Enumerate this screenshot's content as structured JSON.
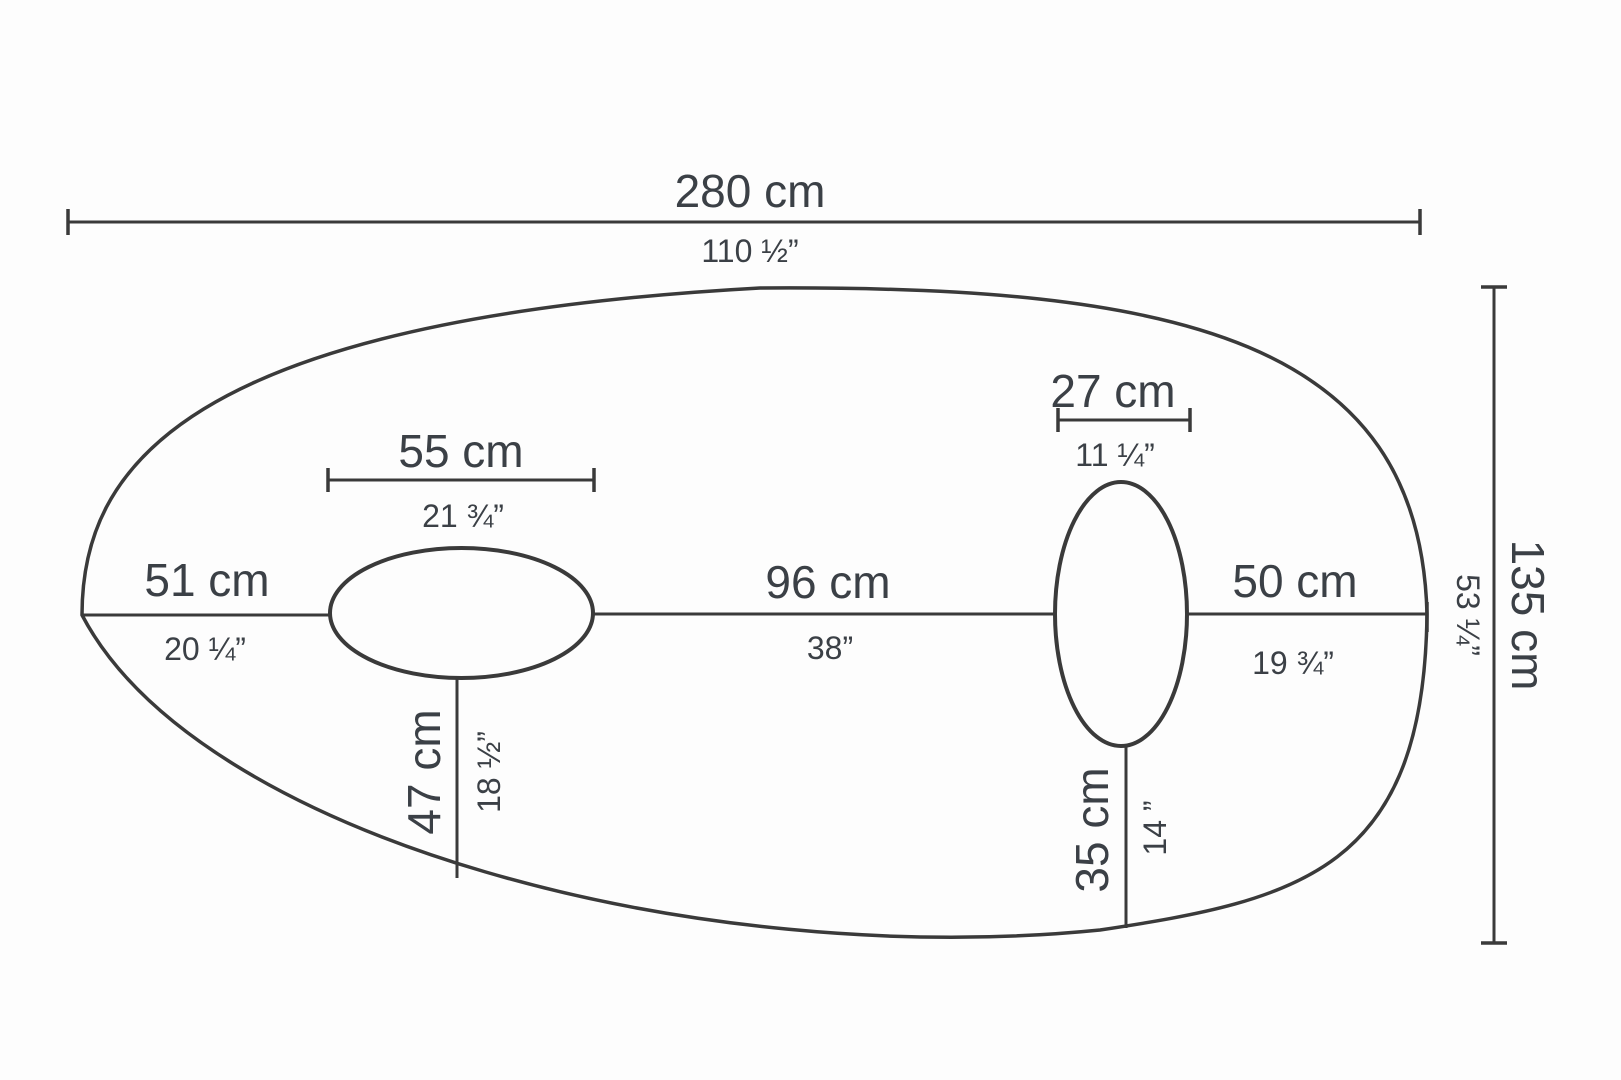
{
  "measurements": {
    "overall_width": {
      "metric": "280 cm",
      "imperial": "110 ½”"
    },
    "overall_height": {
      "metric": "135 cm",
      "imperial": "53 ¼”"
    },
    "left_edge_to_hole1": {
      "metric": "51 cm",
      "imperial": "20 ¼”"
    },
    "hole1_width": {
      "metric": "55 cm",
      "imperial": "21 ¾”"
    },
    "hole1_to_bottom_edge": {
      "metric": "47 cm",
      "imperial": "18 ½”"
    },
    "hole1_to_hole2": {
      "metric": "96 cm",
      "imperial": "38”"
    },
    "hole2_width": {
      "metric": "27 cm",
      "imperial": "11 ¼”"
    },
    "hole2_to_bottom_edge": {
      "metric": "35 cm",
      "imperial": "14 ”"
    },
    "hole2_to_right_edge": {
      "metric": "50 cm",
      "imperial": "19 ¾”"
    }
  },
  "colors": {
    "line": "#3a3a3a",
    "text": "#3b4046",
    "background": "#fdfdfd"
  }
}
